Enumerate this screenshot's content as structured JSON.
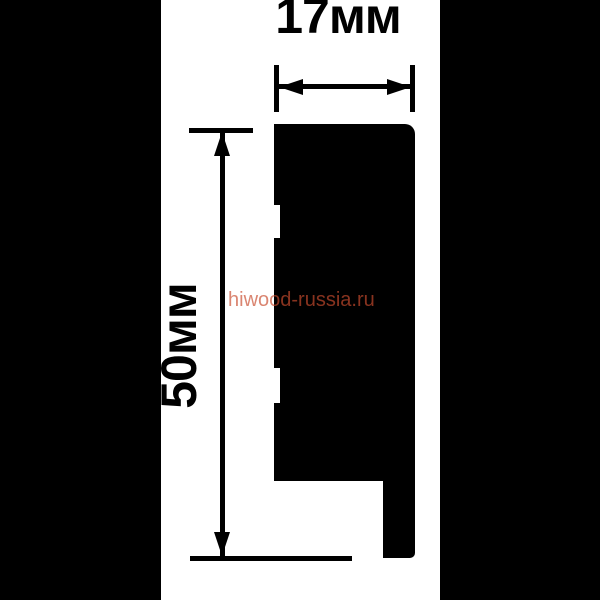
{
  "drawing": {
    "type": "molding-profile-cross-section",
    "dimensions": {
      "width_label": "17мм",
      "height_label": "50мм"
    },
    "watermark": {
      "text": "hiwood-russia.ru"
    },
    "colors": {
      "background": "#ffffff",
      "ink": "#000000",
      "letterbox": "#000000",
      "watermark": "rgba(200, 75, 45, 0.68)"
    }
  }
}
